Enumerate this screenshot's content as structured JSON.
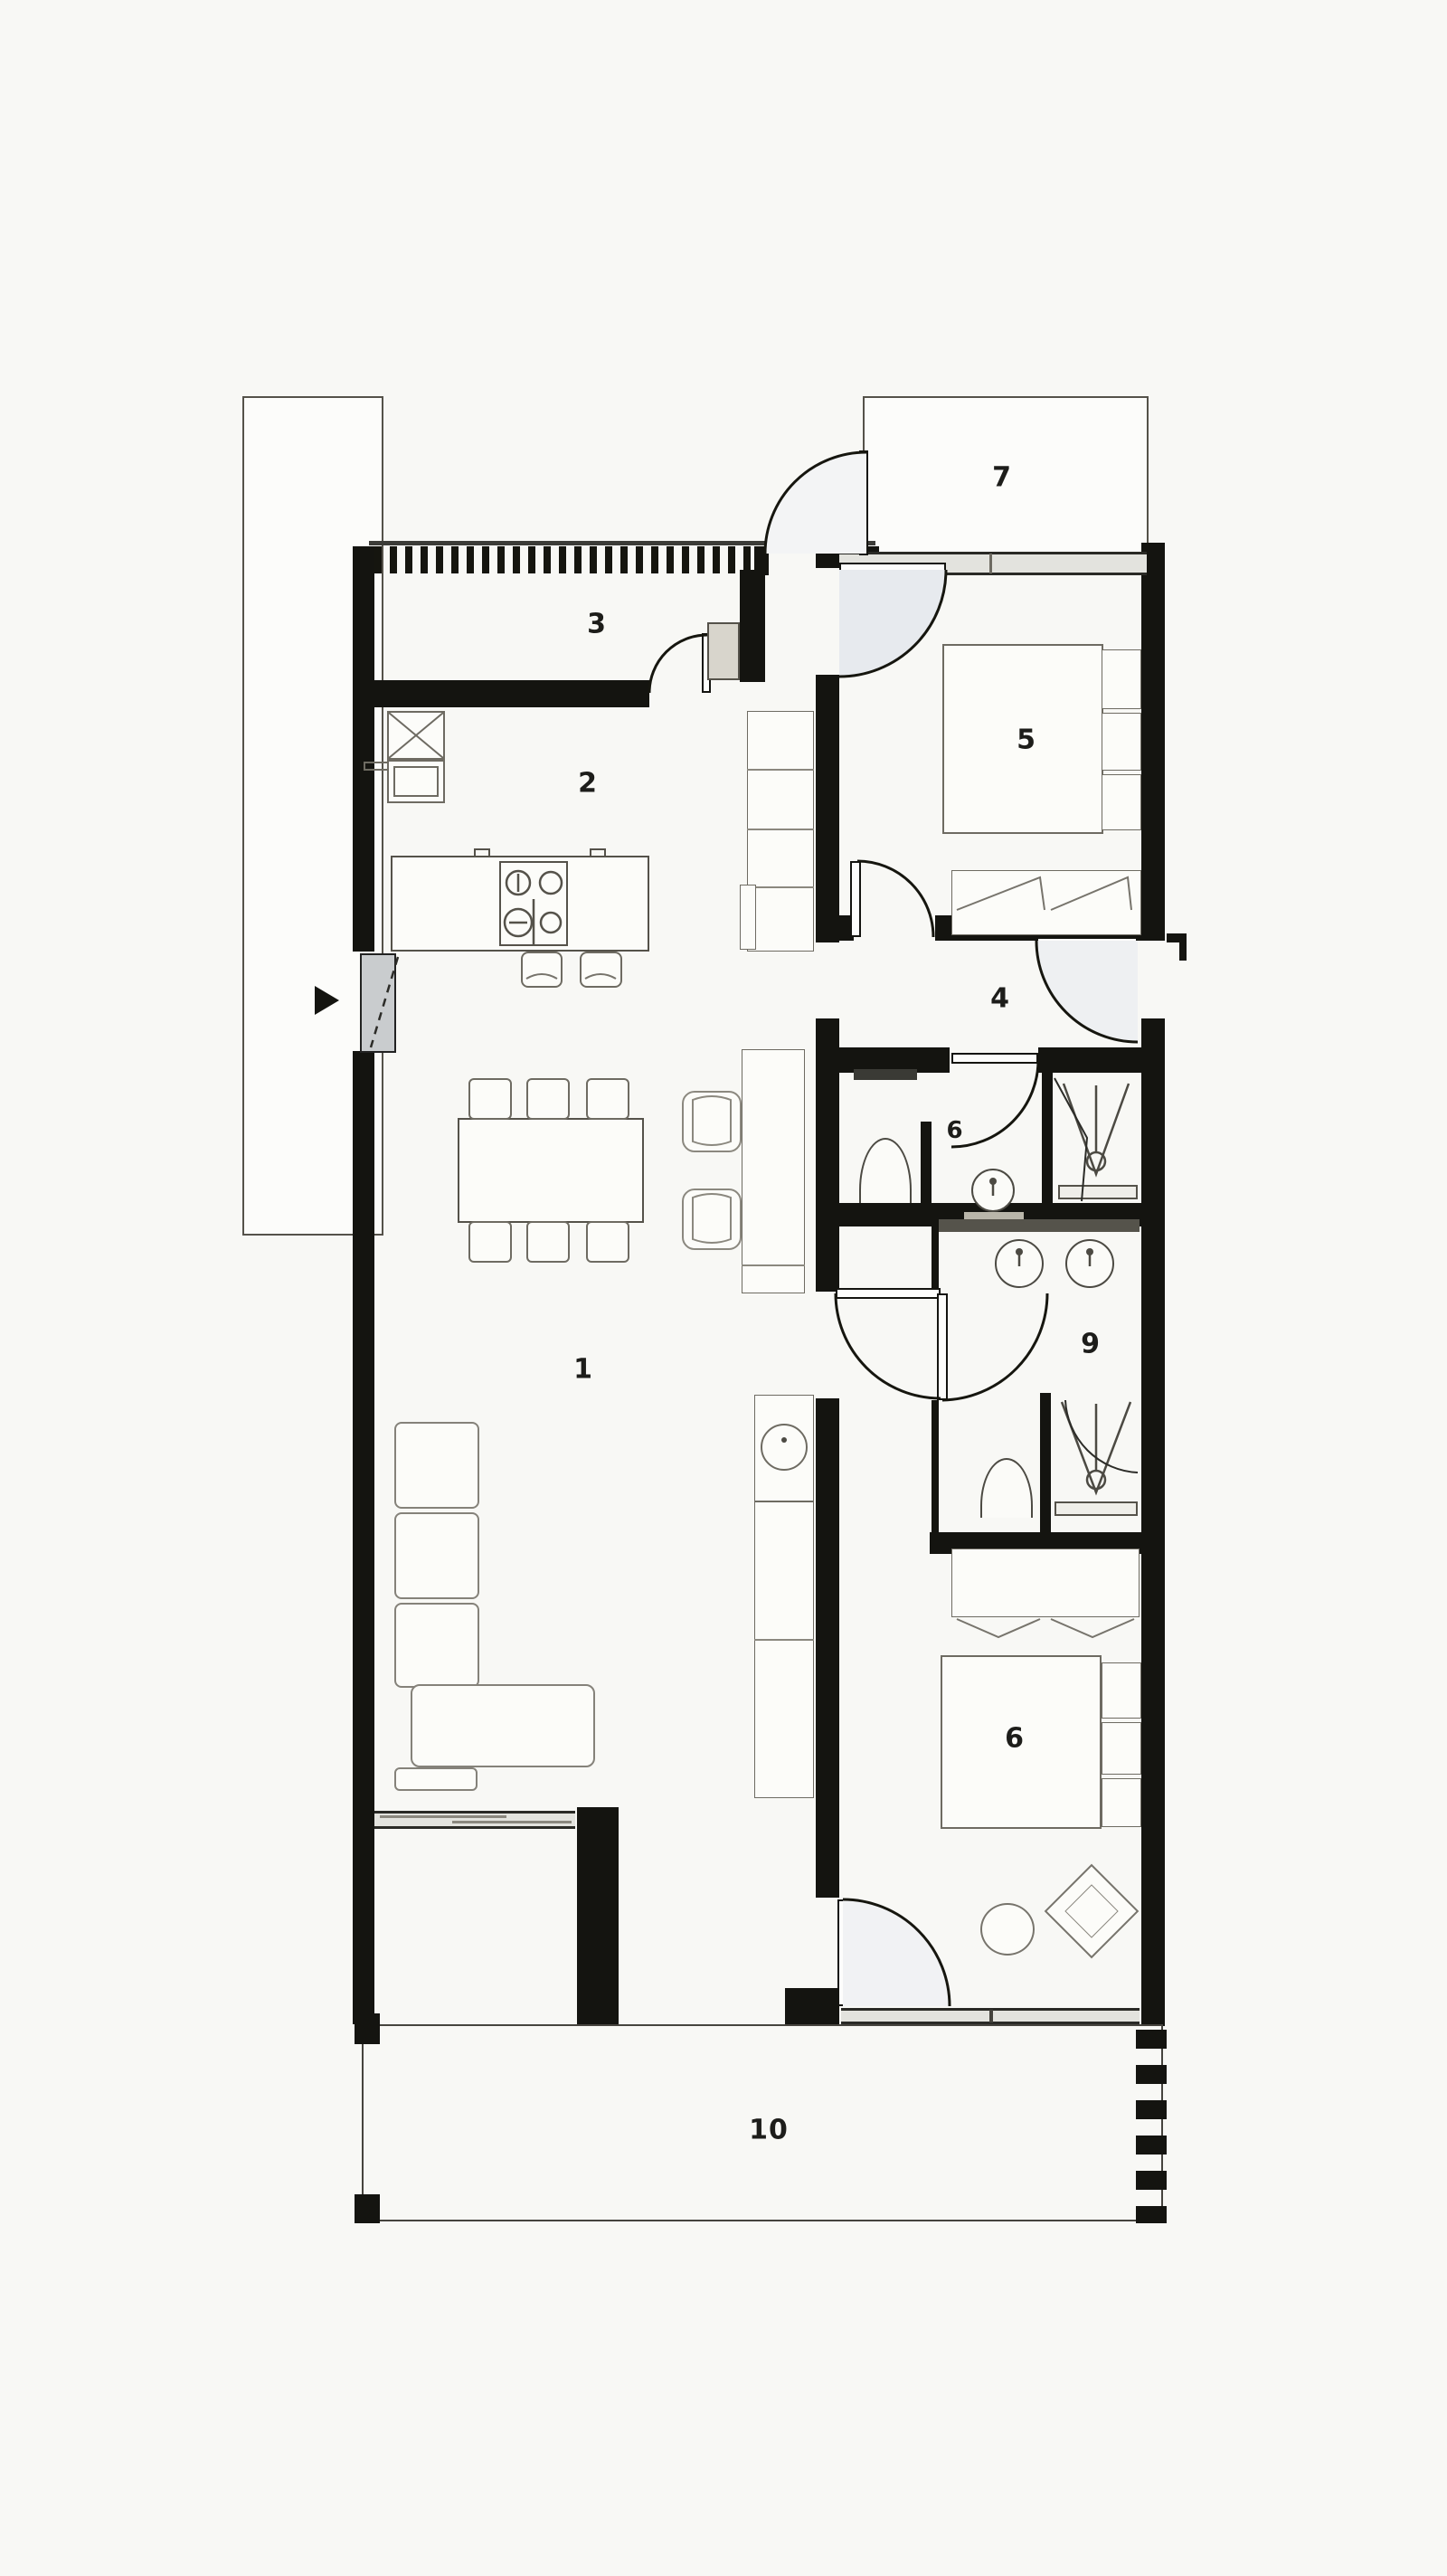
{
  "document": {
    "type": "architectural floor plan",
    "view": "top-down black and white"
  },
  "colors": {
    "background": "#f8f8f5",
    "walls": "#141410",
    "thin_line": "#55524a",
    "furniture_line": "#6e6b62",
    "glazing": "#e3e3de",
    "door_fan_shade": "#e7eaee",
    "label_text": "#1d1d1a"
  },
  "rooms": [
    {
      "label": "1",
      "name": "living-dining-area"
    },
    {
      "label": "2",
      "name": "kitchen"
    },
    {
      "label": "3",
      "name": "entrance-hall"
    },
    {
      "label": "4",
      "name": "corridor"
    },
    {
      "label": "5",
      "name": "bedroom-top"
    },
    {
      "label": "6",
      "name": "bathroom-small"
    },
    {
      "label": "7",
      "name": "balcony-top"
    },
    {
      "label": "9",
      "name": "bathroom-large"
    },
    {
      "label": "6",
      "name": "bedroom-bottom"
    },
    {
      "label": "10",
      "name": "terrace"
    }
  ],
  "icons": [
    "entrance-arrow-icon",
    "door-swing-icon",
    "cooktop-burners-icon",
    "shower-drain-icon",
    "washbasin-icon",
    "toilet-icon",
    "wardrobe-chevron-icon"
  ],
  "furniture": [
    "kitchen-island-with-cooktop",
    "bar-stools",
    "tall-cabinet-column",
    "kitchen-sink-unit",
    "dining-table-with-six-chairs",
    "two-lounge-chairs",
    "corner-sofa",
    "sideboard-counter",
    "double-bed-with-pillows-top",
    "double-bed-with-pillows-bottom",
    "wardrobe-dresser",
    "toilet",
    "round-washbasin",
    "double-vanity-basins",
    "shower-cabin",
    "round-pouf",
    "diamond-pouf",
    "sliding-glass-doors",
    "hatched-entry-wall",
    "terrace-deck-edge"
  ]
}
